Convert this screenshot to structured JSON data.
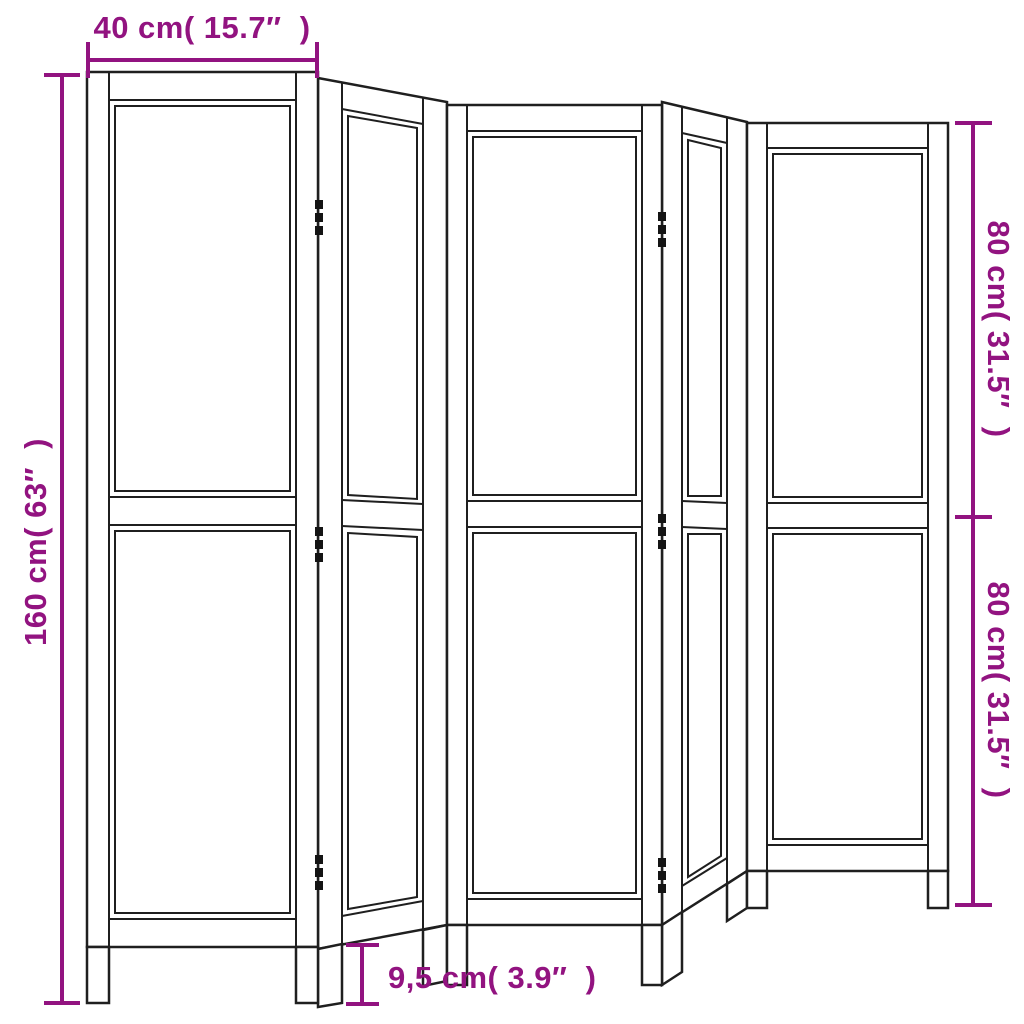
{
  "scene": {
    "type": "product dimension diagram",
    "subject": "5-panel wooden room divider with carved lattice panels",
    "panel_count": 5
  },
  "colors": {
    "accent": "#921380",
    "line": "#1f1f1f",
    "background": "#ffffff",
    "hinge": "#141414"
  },
  "dimensions": {
    "top": {
      "label": "40 cm( 15.7″  )",
      "cm": "40",
      "inch": "15.7"
    },
    "left": {
      "label": "160 cm( 63″  )",
      "cm": "160",
      "inch": "63"
    },
    "right_top": {
      "label": "80 cm( 31.5″  )",
      "cm": "80",
      "inch": "31.5"
    },
    "right_bottom": {
      "label": "80 cm( 31.5″  )",
      "cm": "80",
      "inch": "31.5"
    },
    "bottom": {
      "label": "9,5 cm( 3.9″  )",
      "cm": "9,5",
      "inch": "3.9"
    }
  }
}
